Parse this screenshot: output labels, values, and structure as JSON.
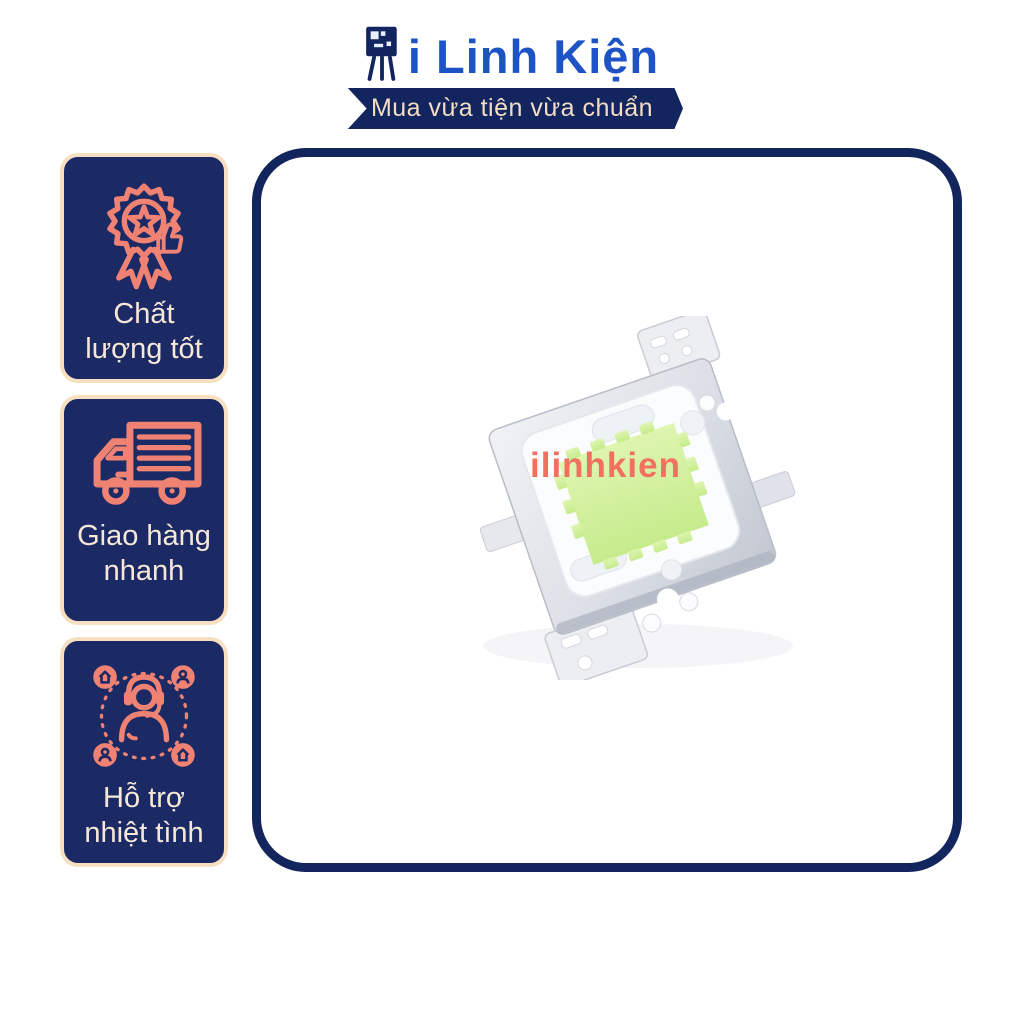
{
  "page": {
    "background": "#ffffff"
  },
  "brand": {
    "logo_icon": "transistor-icon",
    "name": "i Linh Kiện",
    "tagline": "Mua vừa tiện vừa chuẩn",
    "colors": {
      "brand_blue": "#1d53c5",
      "ribbon_navy": "#13255e",
      "tagline_text": "#f3ddc4"
    }
  },
  "sidebar": {
    "colors": {
      "badge_bg": "#1b2a65",
      "badge_border": "#f7dfc2",
      "icon_coral": "#ef8273",
      "label_text": "#f6e7d7"
    },
    "badges": [
      {
        "icon": "quality-medal-icon",
        "lines": [
          "Chất",
          "lượng tốt"
        ]
      },
      {
        "icon": "delivery-truck-icon",
        "lines": [
          "Giao hàng",
          "nhanh"
        ]
      },
      {
        "icon": "customer-support-icon",
        "lines": [
          "Hỗ trợ",
          "nhiệt tình"
        ]
      }
    ]
  },
  "main": {
    "frame_border_color": "#12255c",
    "product": {
      "watermark": "ilinhkien",
      "watermark_color": "#f2705f",
      "phosphor_green": "#cdee9b",
      "plate_silver": "#cdd1da"
    }
  }
}
